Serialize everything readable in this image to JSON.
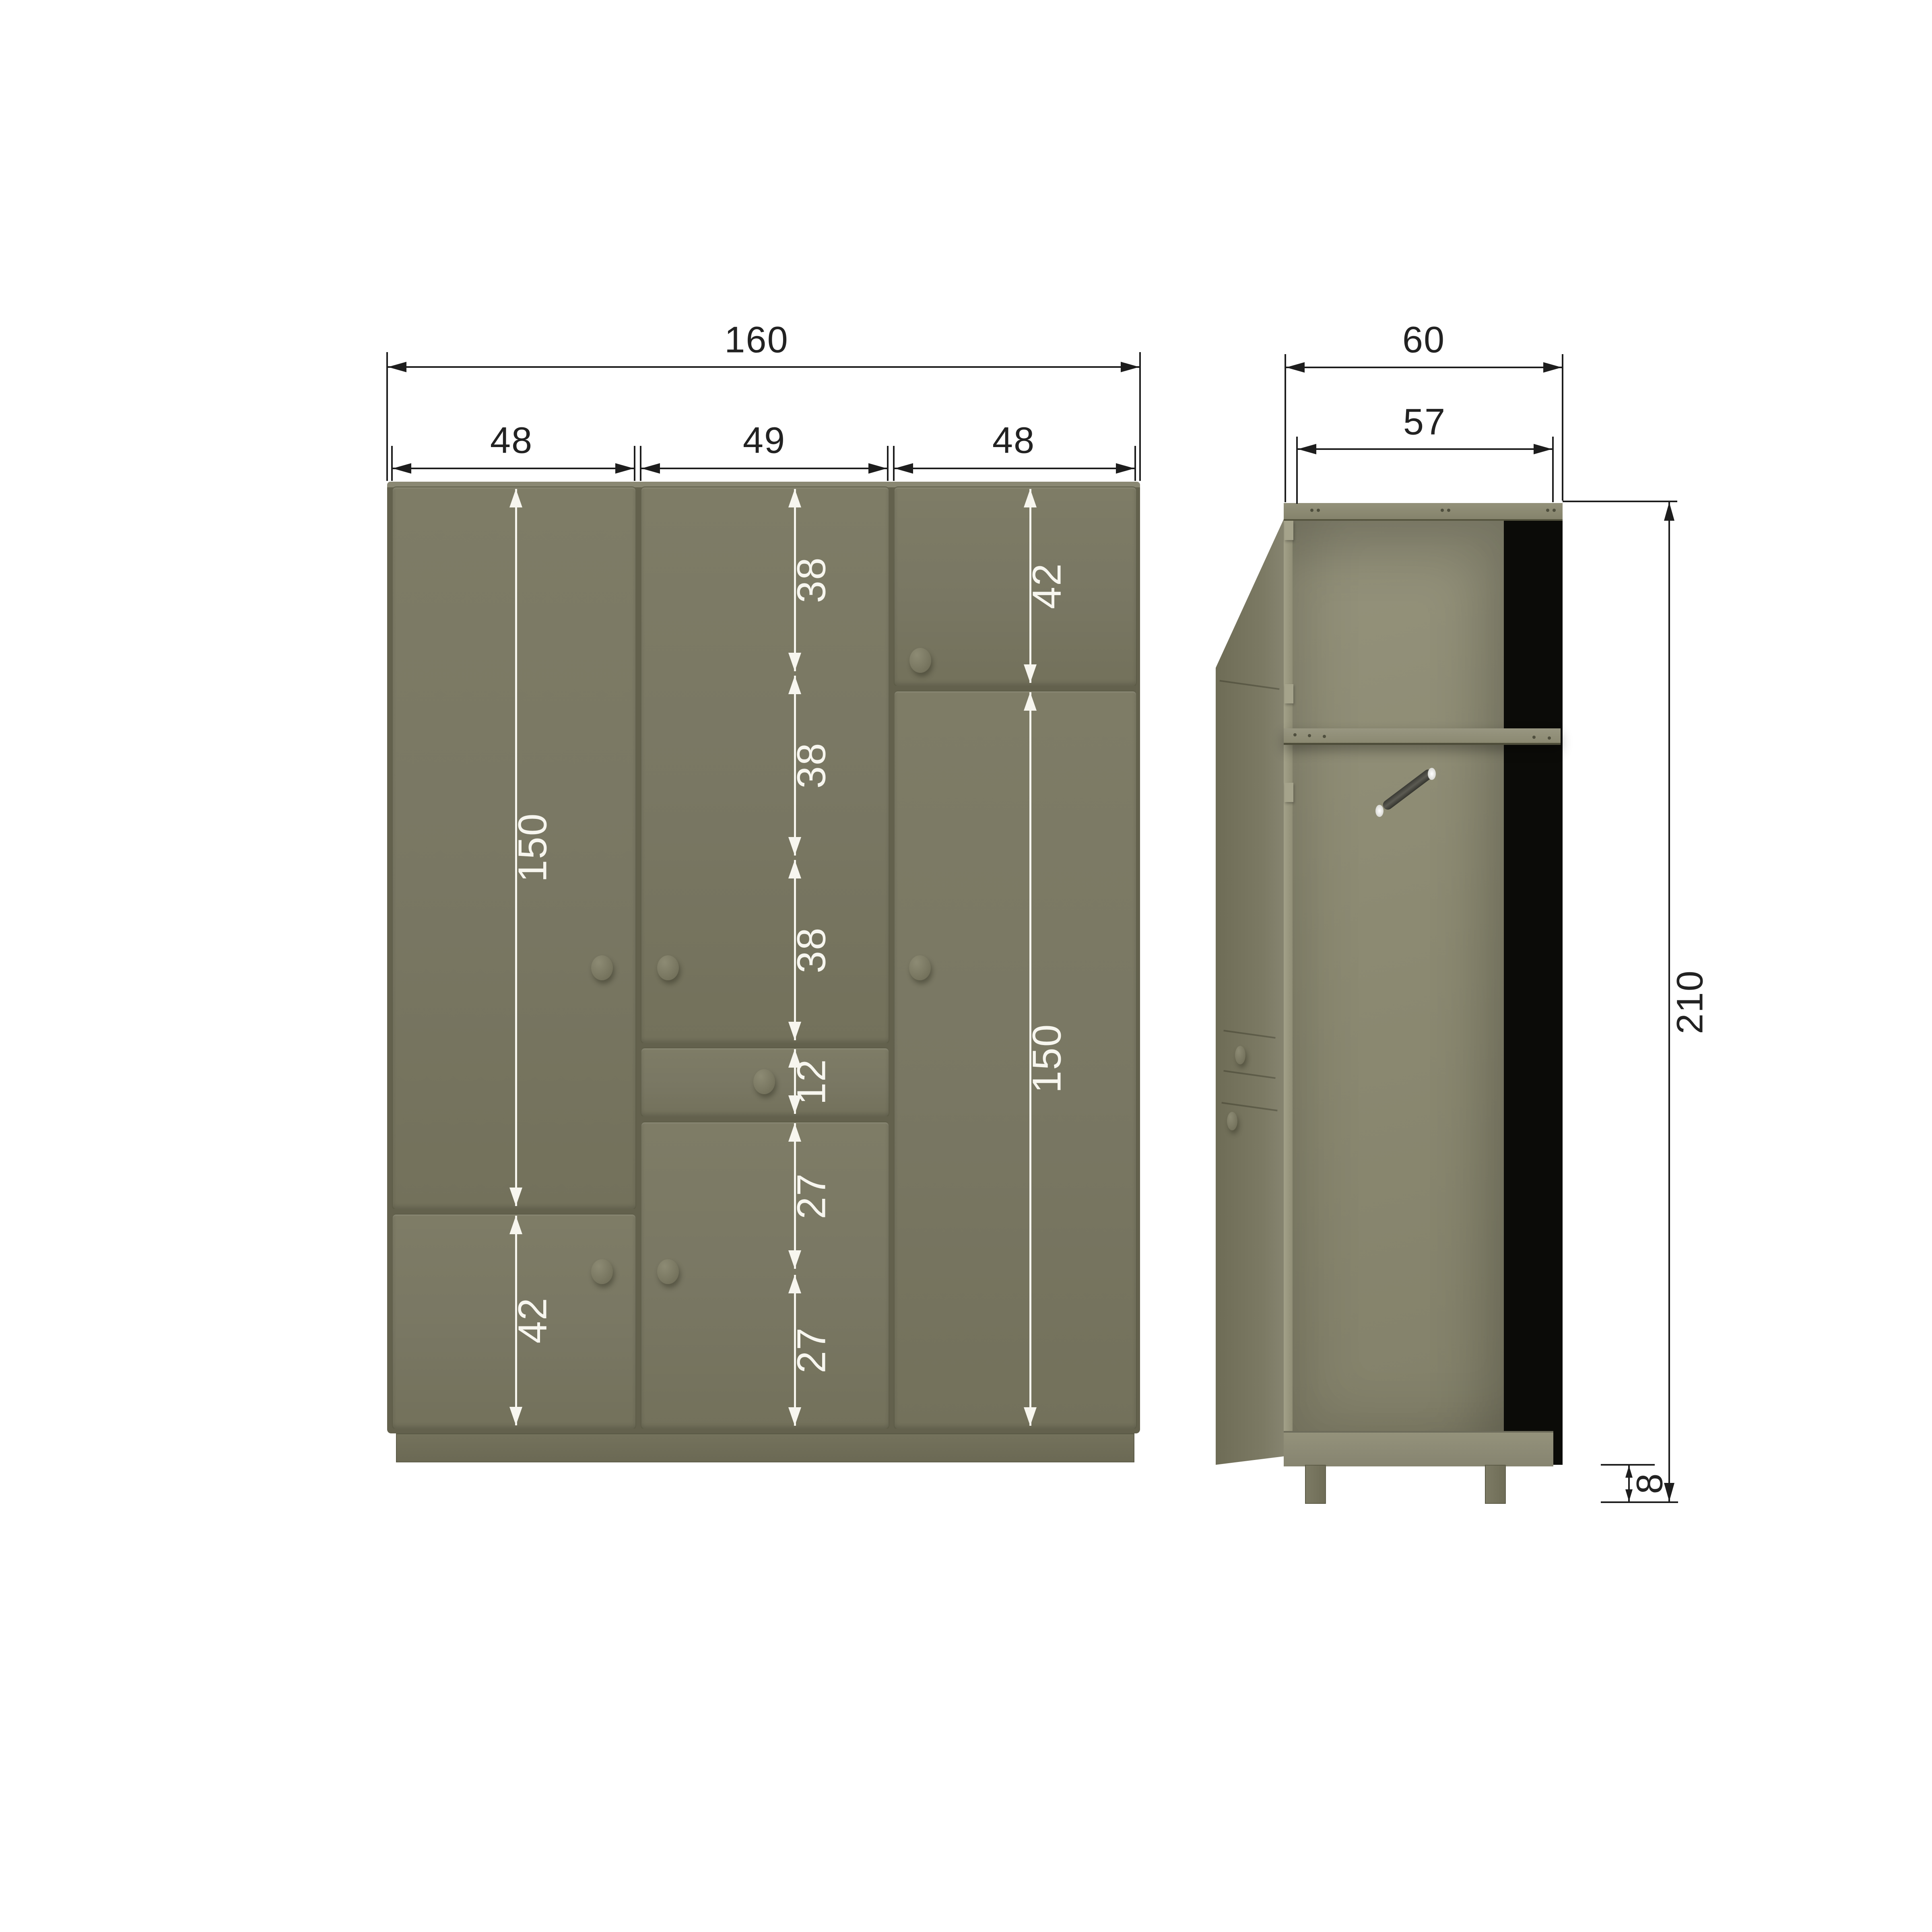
{
  "diagram": {
    "type": "wardrobe dimension drawing",
    "units_implied": "cm",
    "front": {
      "overall_width": "160",
      "section_widths": [
        "48",
        "49",
        "48"
      ],
      "left_tall_door": "150",
      "left_bottom_door": "42",
      "middle_segments": [
        "38",
        "38",
        "38"
      ],
      "drawer_height": "12",
      "middle_bottom_segments": [
        "27",
        "27"
      ],
      "right_top_door": "42",
      "right_tall_door": "150"
    },
    "side": {
      "outer_depth": "60",
      "inner_depth": "57",
      "overall_height": "210",
      "plinth_height": "8"
    },
    "colors": {
      "body_olive": "#797763",
      "carcass_dark": "#63614d",
      "interior_olive": "#8c8a72",
      "back_panel": "#0b0b08",
      "dimension_line": "#1d1d1d",
      "dimension_label_light": "#f7f6ef",
      "background": "#ffffff"
    }
  }
}
